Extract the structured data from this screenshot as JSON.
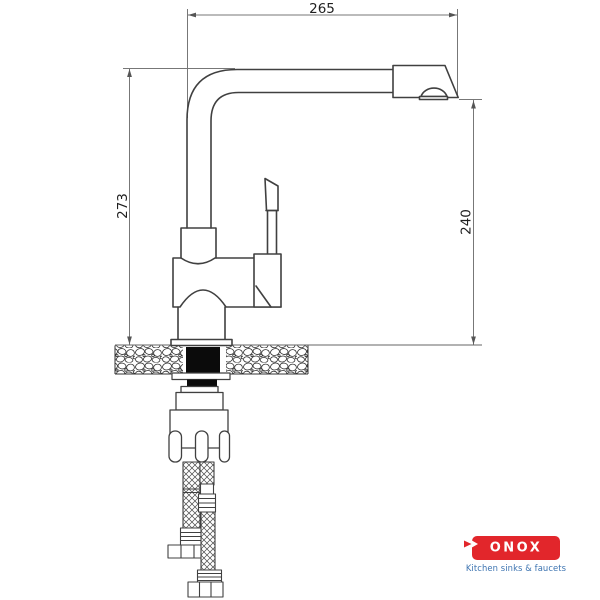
{
  "dimensions": {
    "top_width": "265",
    "left_height": "273",
    "right_height": "240"
  },
  "logo": {
    "brand": "KONOX",
    "brand_display_rest": "ONOX",
    "tagline": "Kitchen sinks & faucets",
    "brand_bg_color": "#e2262b",
    "brand_text_color": "#ffffff",
    "tagline_color": "#3d74b1"
  },
  "drawing": {
    "line_color": "#404040",
    "dimension_line_color": "#777777",
    "fill_black": "#0b0b0b"
  }
}
